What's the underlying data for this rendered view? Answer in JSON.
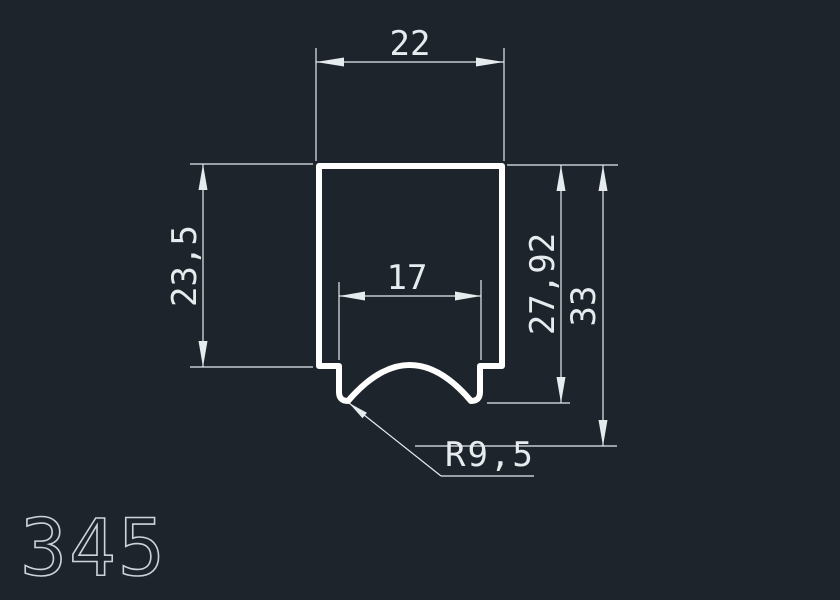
{
  "canvas": {
    "background": "#1e242c",
    "profile_color": "#ffffff",
    "dim_color": "#e6ebee",
    "part_number_color": "#ccd3d9"
  },
  "drawing": {
    "part_number": "345",
    "dimensions": [
      {
        "name": "outer-width-top",
        "label": "22",
        "value": 22,
        "orientation": "horizontal"
      },
      {
        "name": "left-height",
        "label": "23,5",
        "value": 23.5,
        "orientation": "vertical"
      },
      {
        "name": "groove-width",
        "label": "17",
        "value": 17,
        "orientation": "horizontal"
      },
      {
        "name": "inner-right-height",
        "label": "27,92",
        "value": 27.92,
        "orientation": "vertical"
      },
      {
        "name": "total-height",
        "label": "33",
        "value": 33,
        "orientation": "vertical"
      },
      {
        "name": "groove-radius",
        "label": "R9,5",
        "value": 9.5,
        "orientation": "leader"
      }
    ]
  }
}
